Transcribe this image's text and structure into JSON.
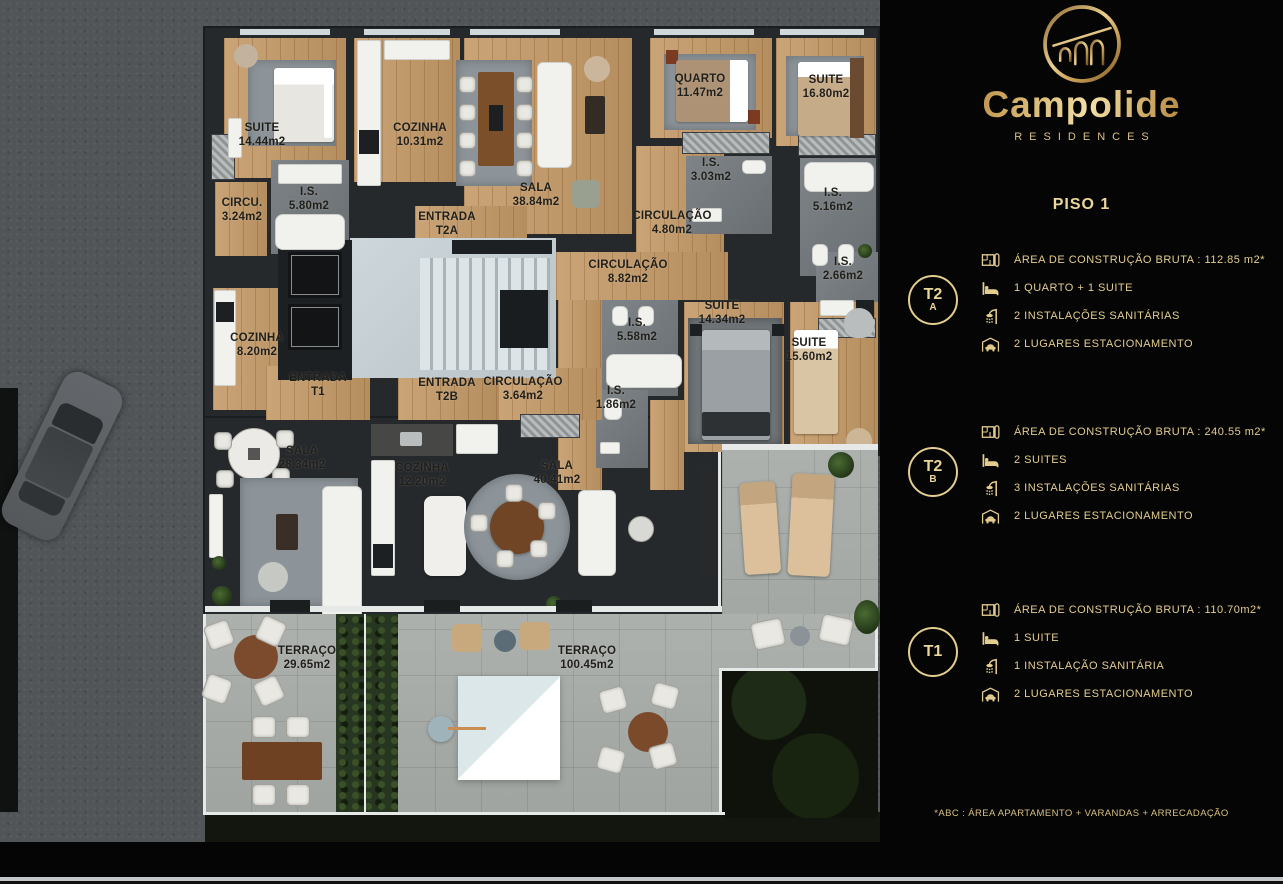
{
  "brand": {
    "name": "Campolide",
    "subtitle": "RESIDENCES"
  },
  "panel": {
    "floor_title": "PISO 1",
    "footnote": "*ABC :  ÁREA APARTAMENTO + VARANDAS + ARRECADAÇÃO",
    "units": [
      {
        "badge_line1": "T2",
        "badge_line2": "A",
        "rows": [
          {
            "icon": "floorplan-icon",
            "text": "ÁREA DE CONSTRUÇÃO BRUTA :  112.85 m2*"
          },
          {
            "icon": "bed-icon",
            "text": "1 QUARTO + 1 SUITE"
          },
          {
            "icon": "shower-icon",
            "text": "2 INSTALAÇÕES SANITÁRIAS"
          },
          {
            "icon": "car-garage-icon",
            "text": "2 LUGARES ESTACIONAMENTO"
          }
        ]
      },
      {
        "badge_line1": "T2",
        "badge_line2": "B",
        "rows": [
          {
            "icon": "floorplan-icon",
            "text": "ÁREA DE CONSTRUÇÃO BRUTA :  240.55 m2*"
          },
          {
            "icon": "bed-icon",
            "text": "2 SUITES"
          },
          {
            "icon": "shower-icon",
            "text": "3 INSTALAÇÕES SANITÁRIAS"
          },
          {
            "icon": "car-garage-icon",
            "text": "2 LUGARES ESTACIONAMENTO"
          }
        ]
      },
      {
        "badge_line1": "T1",
        "badge_line2": "",
        "rows": [
          {
            "icon": "floorplan-icon",
            "text": "ÁREA DE CONSTRUÇÃO BRUTA :  110.70m2*"
          },
          {
            "icon": "bed-icon",
            "text": "1 SUITE"
          },
          {
            "icon": "shower-icon",
            "text": "1 INSTALAÇÃO SANITÁRIA"
          },
          {
            "icon": "car-garage-icon",
            "text": "2 LUGARES ESTACIONAMENTO"
          }
        ]
      }
    ]
  },
  "plan": {
    "rooms": [
      {
        "name": "SUITE",
        "area": "14.44m2"
      },
      {
        "name": "COZINHA",
        "area": "10.31m2"
      },
      {
        "name": "SALA",
        "area": "38.84m2"
      },
      {
        "name": "QUARTO",
        "area": "11.47m2"
      },
      {
        "name": "SUITE",
        "area": "16.80m2"
      },
      {
        "name": "I.S.",
        "area": "5.80m2"
      },
      {
        "name": "CIRCU.",
        "area": "3.24m2"
      },
      {
        "name": "ENTRADA",
        "area": "T2A"
      },
      {
        "name": "CIRCULAÇÃO",
        "area": "4.80m2"
      },
      {
        "name": "I.S.",
        "area": "3.03m2"
      },
      {
        "name": "I.S.",
        "area": "5.16m2"
      },
      {
        "name": "CIRCULAÇÃO",
        "area": "8.82m2"
      },
      {
        "name": "I.S.",
        "area": "2.66m2"
      },
      {
        "name": "SUITE",
        "area": "14.34m2"
      },
      {
        "name": "I.S.",
        "area": "5.58m2"
      },
      {
        "name": "SUITE",
        "area": "15.60m2"
      },
      {
        "name": "I.S.",
        "area": "1.86m2"
      },
      {
        "name": "COZINHA",
        "area": "8.20m2"
      },
      {
        "name": "ENTRADA",
        "area": "T1"
      },
      {
        "name": "ENTRADA",
        "area": "T2B"
      },
      {
        "name": "CIRCULAÇÃO",
        "area": "3.64m2"
      },
      {
        "name": "SALA",
        "area": "28.34m2"
      },
      {
        "name": "COZINHA",
        "area": "12.20m2"
      },
      {
        "name": "SALA",
        "area": "40.41m2"
      },
      {
        "name": "TERRAÇO",
        "area": "29.65m2"
      },
      {
        "name": "TERRAÇO",
        "area": "100.45m2"
      }
    ]
  },
  "colors": {
    "gold": "#e3cd8f",
    "panel_bg": "#050505",
    "wood_floor": "#c49a67",
    "wall": "#26292c",
    "terrace_tile": "#a8ada9",
    "street": "#515558",
    "hedge": "#273620"
  }
}
